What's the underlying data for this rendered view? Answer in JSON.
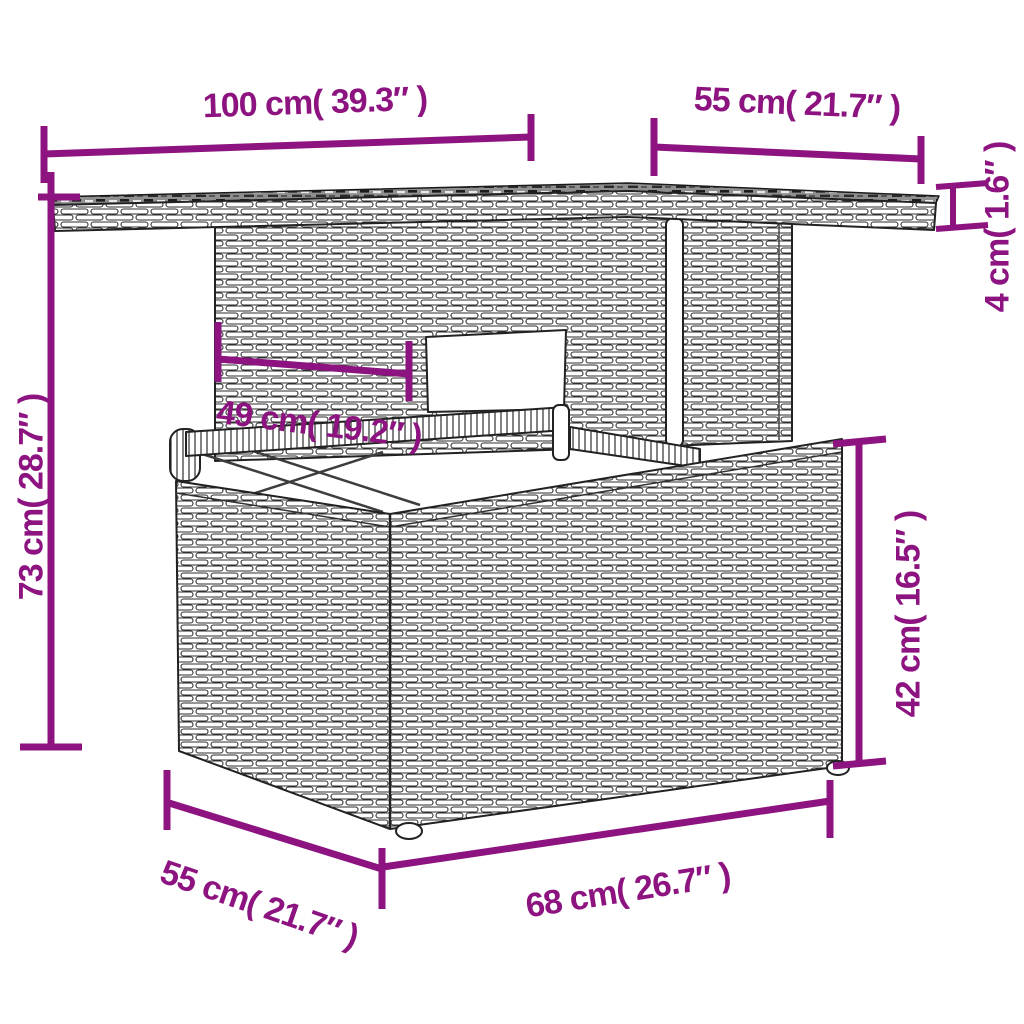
{
  "diagram": {
    "subject": "poly rattan garden table dimension drawing",
    "accent_color": "#8d1480",
    "outline_color": "#2e2e2e",
    "background_color": "#ffffff",
    "dimensions": [
      {
        "id": "tabletop-width",
        "label": "100 cm( 39.3″ )",
        "cm": 100,
        "inches": 39.3,
        "orientation": "horizontal-top-left"
      },
      {
        "id": "tabletop-depth",
        "label": "55 cm( 21.7″ )",
        "cm": 55,
        "inches": 21.7,
        "orientation": "horizontal-top-right"
      },
      {
        "id": "tabletop-thickness",
        "label": "4 cm( 1.6″ )",
        "cm": 4,
        "inches": 1.6,
        "orientation": "vertical-right"
      },
      {
        "id": "total-height",
        "label": "73 cm( 28.7″ )",
        "cm": 73,
        "inches": 28.7,
        "orientation": "vertical-left"
      },
      {
        "id": "pedestal-width",
        "label": "49 cm( 19.2″ )",
        "cm": 49,
        "inches": 19.2,
        "orientation": "horizontal-middle"
      },
      {
        "id": "base-height",
        "label": "42 cm( 16.5″ )",
        "cm": 42,
        "inches": 16.5,
        "orientation": "vertical-right-lower"
      },
      {
        "id": "base-depth",
        "label": "55 cm( 21.7″ )",
        "cm": 55,
        "inches": 21.7,
        "orientation": "diagonal-bottom-left"
      },
      {
        "id": "base-width",
        "label": "68 cm( 26.7″ )",
        "cm": 68,
        "inches": 26.7,
        "orientation": "diagonal-bottom"
      }
    ]
  }
}
